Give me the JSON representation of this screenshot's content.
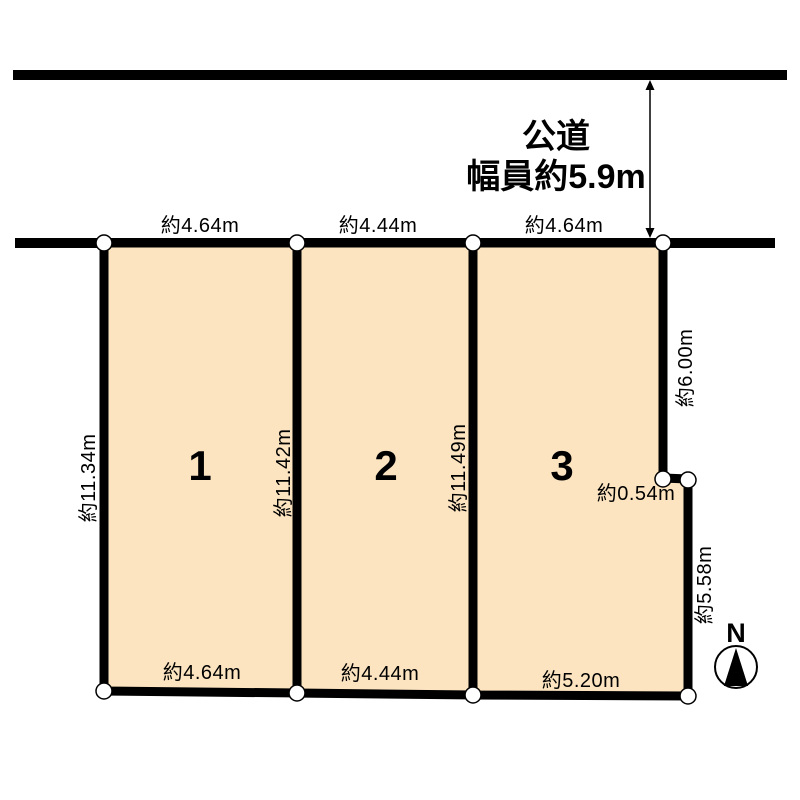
{
  "road": {
    "name": "公道",
    "width_label": "幅員約5.9m"
  },
  "plots": [
    {
      "number": "1",
      "top_dim": "約4.64m",
      "left_dim": "約11.34m",
      "right_dim": "約11.42m",
      "bottom_dim": "約4.64m"
    },
    {
      "number": "2",
      "top_dim": "約4.44m",
      "right_dim": "約11.49m",
      "bottom_dim": "約4.44m"
    },
    {
      "number": "3",
      "top_dim": "約4.64m",
      "right_upper_dim": "約6.00m",
      "notch_dim": "約0.54m",
      "right_lower_dim": "約5.58m",
      "bottom_dim": "約5.20m"
    }
  ],
  "compass": {
    "label": "N"
  },
  "colors": {
    "plot_fill": "#fce4c1",
    "line": "#000000",
    "marker_fill": "#ffffff"
  }
}
